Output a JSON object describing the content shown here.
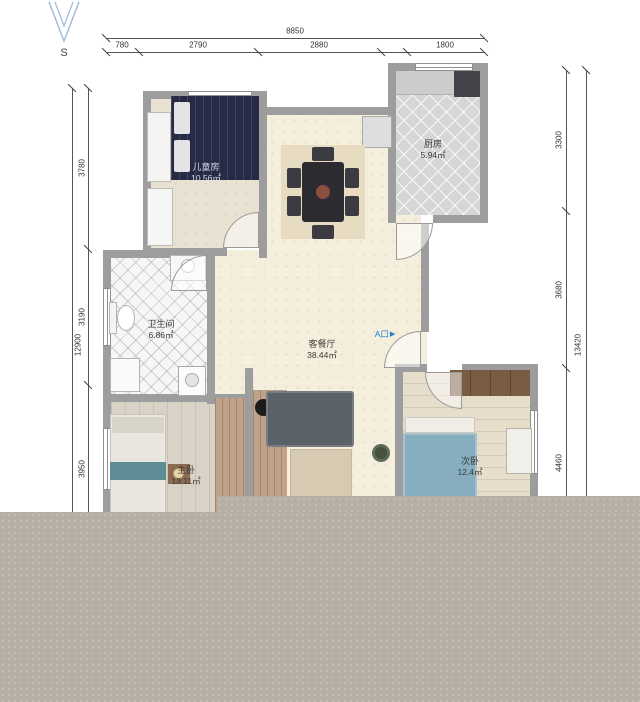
{
  "compass": {
    "label": "S"
  },
  "entrance": {
    "label": "A口",
    "arrow": "▶"
  },
  "rooms": [
    {
      "name": "儿童房",
      "area": "10.56㎡"
    },
    {
      "name": "厨房",
      "area": "5.94㎡"
    },
    {
      "name": "卫生间",
      "area": "6.86㎡"
    },
    {
      "name": "客餐厅",
      "area": "38.44㎡"
    },
    {
      "name": "主卧",
      "area": "13.11㎡"
    },
    {
      "name": "次卧",
      "area": "12.4㎡"
    }
  ],
  "dimensions": {
    "top": {
      "total": "8850",
      "segments": [
        "780",
        "2790",
        "2880",
        "1800"
      ]
    },
    "left": {
      "total": "12900",
      "segments": [
        "3780",
        "3190",
        "3950"
      ]
    },
    "right": {
      "total": "13420",
      "segments": [
        "3300",
        "3680",
        "4460"
      ]
    }
  },
  "colors": {
    "wall": "#9d9d9d",
    "floor_living": "#f4eedd",
    "floor_kitchen": "#d6d6d6",
    "floor_bath": "#f6f6f6",
    "overlay": "#b5afa5",
    "entrance_accent": "#1f7ad4",
    "dimension_text": "#333333"
  }
}
